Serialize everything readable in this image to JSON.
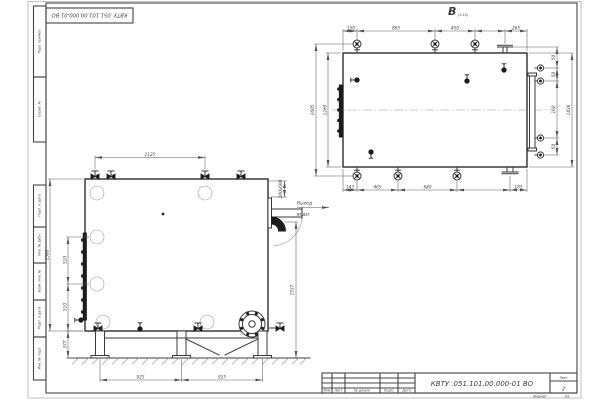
{
  "sheet": {
    "code": "КВТУ .051.101.00.000-01  ВО",
    "format_label": "Формат",
    "format_value": "А3",
    "sheet_label": "Лист",
    "sheet_number": "2",
    "columns": {
      "izm": "Изм",
      "list": "Лист",
      "doc": "№ докум.",
      "podp": "Подп.",
      "data": "Дата"
    },
    "side": {
      "perv": "Перв. примен.",
      "sprav": "Справ. №",
      "podp1": "Подп. и дата",
      "inv_dubl": "Инв. № дубл.",
      "vzam": "Взам. инв. №",
      "podp2": "Подп. и дата",
      "inv_podl": "Инв. № подл."
    }
  },
  "top_view": {
    "label": "В",
    "scale": "(1:10)",
    "dim_top_1": "150",
    "dim_top_2": "865",
    "dim_top_3": "450",
    "dim_top_4": "265",
    "dim_bottom_1": "143",
    "dim_bottom_2": "465",
    "dim_bottom_3": "640",
    "dim_bottom_4": "185",
    "dim_right_1": "50",
    "dim_right_2": "50",
    "dim_right_3": "160",
    "dim_right_4": "50",
    "dim_right_overall": "1438",
    "dim_left_outer": "1605",
    "dim_left_inner": "1260"
  },
  "front_view": {
    "dim_top": "1125",
    "dim_left_overall": "1500",
    "dim_left_1": "510",
    "dim_left_2": "510",
    "dim_left_3": "377",
    "dim_right": "1537",
    "dim_bottom_1": "925",
    "dim_bottom_2": "925",
    "outlet_size": "200х600",
    "outlet_word_1": "Выход",
    "outlet_word_2": "воды"
  }
}
